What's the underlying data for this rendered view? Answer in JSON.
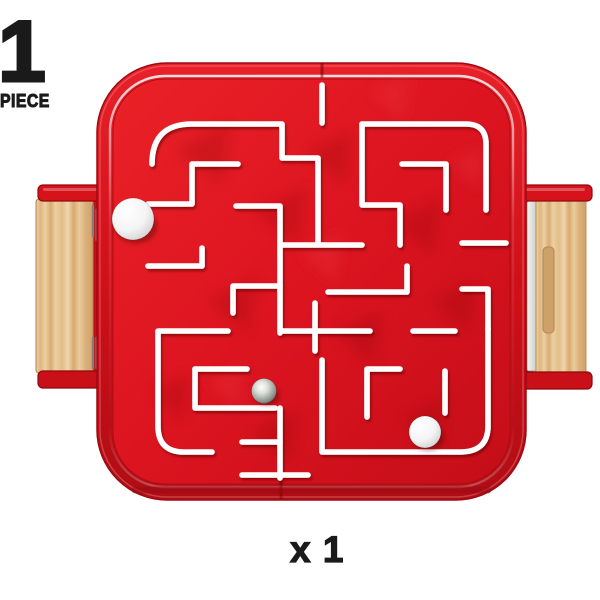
{
  "page": {
    "background_color": "#ffffff",
    "text_color": "#1a1a1a"
  },
  "quantity_badge": {
    "number": "1",
    "unit_label": "PIECE"
  },
  "quantity_footer": {
    "label": "x 1"
  },
  "product": {
    "kind": "red-labyrinth-maze-game-with-wooden-side-handles",
    "colors": {
      "tray_red": "#dc1420",
      "tray_red_dark": "#a30c13",
      "tray_rim_highlight": "#ffffff",
      "maze_wall_white": "#ffffff",
      "wood_light": "#eccfa2",
      "wood_dark": "#d3a872",
      "metal_clip": "#e7e7e5",
      "steel_ball": "#9aa09a",
      "white_ball": "#f4f4f4"
    },
    "maze": {
      "wall_stroke_width": 5.6,
      "walls": [
        "M322 85 V123",
        "M152 164 Q152 124 192 124 H282 V158 H318 V243",
        "M362 124 H466 Q486 124 486 144 V210",
        "M362 124 V205 H400 V245",
        "M402 164 H446 V210",
        "M462 243 H506",
        "M148 204 H192 V164 H238",
        "M236 206 H280 V245 H362",
        "M280 245 V333",
        "M233 313 V286 H280",
        "M328 292 H407 V266",
        "M280 331 H370",
        "M413 331 H455",
        "M228 331 H158 V426 Q158 452 184 452 H212",
        "M148 266 H202",
        "M202 248 V266",
        "M195 369 H247",
        "M195 369 V408 H275",
        "M280 408 V478",
        "M242 442 H280",
        "M242 475 H308",
        "M322 360 V452 H460 Q488 452 488 426 V328",
        "M367 417 V369 H400",
        "M445 371 V413",
        "M462 289 H488 V330",
        "M315 303 V351"
      ],
      "balls": [
        {
          "kind": "white",
          "cx": 133,
          "cy": 219,
          "r": 21
        },
        {
          "kind": "steel",
          "cx": 264,
          "cy": 391,
          "r": 12.5
        },
        {
          "kind": "white",
          "cx": 425,
          "cy": 432,
          "r": 16
        }
      ]
    }
  }
}
